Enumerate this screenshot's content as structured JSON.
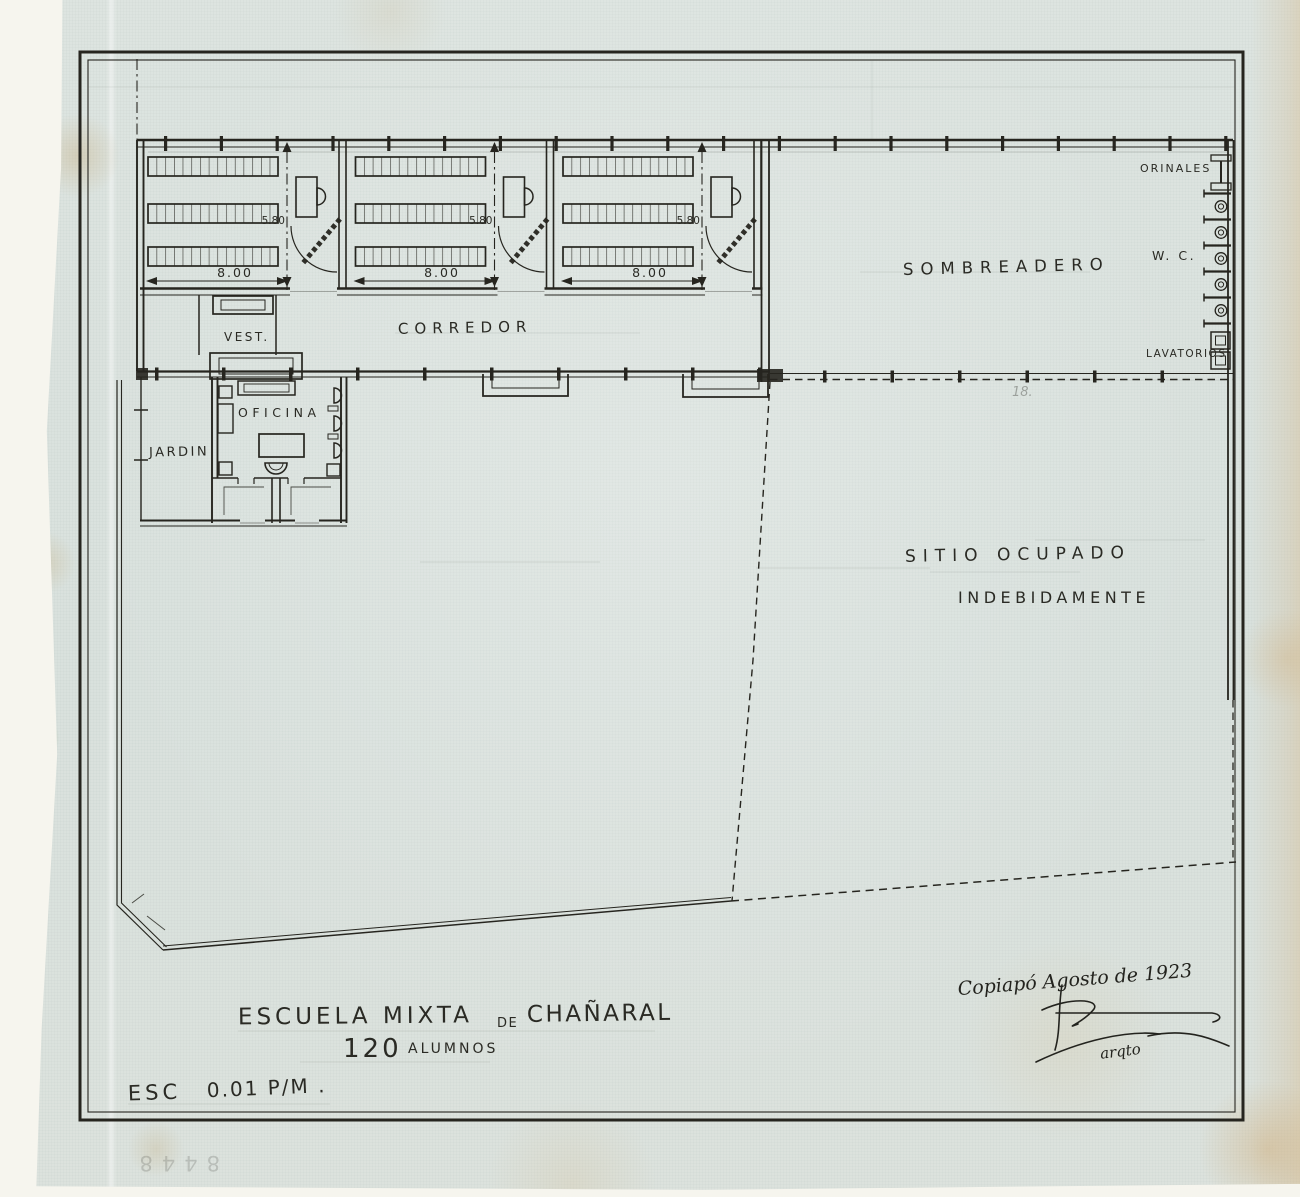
{
  "document": {
    "kind_note": "hand-drawn school floor plan, ink on aged blueprint paper",
    "title_main": "ESCUELA MIXTA",
    "title_connector": "DE",
    "title_place": "CHAÑARAL",
    "students_count": "120",
    "students_word": "ALUMNOS",
    "scale_word": "ESC",
    "scale_value": "0.01 P/M .",
    "date_note": "Copiapó Agosto de 1923",
    "signature_role": "arqto",
    "archive_number": "8448",
    "parcel_note": "18."
  },
  "rooms": {
    "corridor": "CORREDOR",
    "vestibule": "VEST.",
    "office": "OFICINA",
    "garden": "JARDIN",
    "shade_area": "SOMBREADERO",
    "urinals": "ORINALES",
    "wc": "W. C.",
    "lavatories": "LAVATORIOS",
    "occupied_site_line1": "SITIO OCUPADO",
    "occupied_site_line2": "INDEBIDAMENTE"
  },
  "classrooms": [
    {
      "id": "classroom-1",
      "width_m": "8.00",
      "depth_m": "5.80"
    },
    {
      "id": "classroom-2",
      "width_m": "8.00",
      "depth_m": "5.80"
    },
    {
      "id": "classroom-3",
      "width_m": "8.00",
      "depth_m": "5.80"
    }
  ],
  "colors": {
    "ink": "#26251f",
    "paper": "#dce3df",
    "stain": "#c9a36b"
  }
}
